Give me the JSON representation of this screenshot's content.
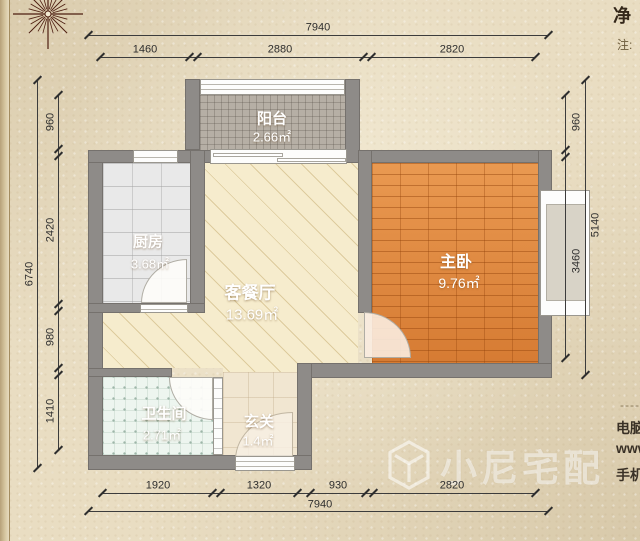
{
  "plan_title": "one-bedroom floor plan",
  "rooms": [
    {
      "name": "阳台",
      "area": "2.66㎡"
    },
    {
      "name": "厨房",
      "area": "3.68㎡"
    },
    {
      "name": "客餐厅",
      "area": "13.69㎡"
    },
    {
      "name": "主卧",
      "area": "9.76㎡"
    },
    {
      "name": "卫生间",
      "area": "2.71㎡"
    },
    {
      "name": "玄关",
      "area": "1.4㎡"
    }
  ],
  "dimensions": {
    "top": {
      "total": "7940",
      "segments": [
        "1460",
        "2880",
        "2820"
      ]
    },
    "bottom": {
      "total": "7940",
      "segments": [
        "1920",
        "1320",
        "930",
        "2820"
      ]
    },
    "left": {
      "total": "6740",
      "segments": [
        "960",
        "2420",
        "980",
        "1410"
      ]
    },
    "right": {
      "total": "5140",
      "segments": [
        "960",
        "3460"
      ]
    }
  },
  "edge_text": {
    "top_big": "净",
    "top_note": "注:",
    "dashes": "-----",
    "line1": "电脑",
    "line2": "www",
    "line3": "手机"
  },
  "watermark": {
    "brand": "小尼宅配"
  },
  "colors": {
    "paper": "#e9ddc2",
    "wall": "#8e8b88",
    "living_floor": "#f6eccd",
    "bedroom_floor": "#e0853c",
    "kitchen_floor": "#e9e9e9",
    "bathroom_floor": "#edf5ef",
    "balcony_floor": "#b6afa5",
    "entry_floor": "#f1e6d1",
    "dimension_ink": "#2e2e2e",
    "label_text": "#ffffff"
  }
}
